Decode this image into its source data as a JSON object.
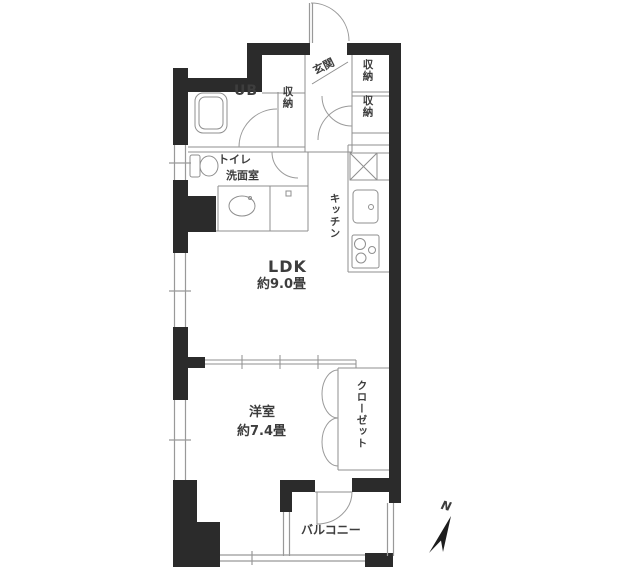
{
  "rooms": {
    "entrance": "玄関",
    "hall_storage": "収納",
    "right_storage_top": "収納",
    "right_storage_bottom": "収納",
    "unit_bath": "UB",
    "toilet": "トイレ",
    "washroom": "洗面室",
    "kitchen": "キッチン",
    "ldk": "LDK",
    "ldk_size": "約9.0畳",
    "western_room": "洋室",
    "western_room_size": "約7.4畳",
    "closet": "クローゼット",
    "balcony": "バルコニー"
  },
  "compass": {
    "north": "N"
  },
  "colors": {
    "wall": "#2b2b2b",
    "line": "#8f8f8f",
    "window_line": "#999999",
    "text": "#3d3d3d",
    "background": "#ffffff"
  }
}
